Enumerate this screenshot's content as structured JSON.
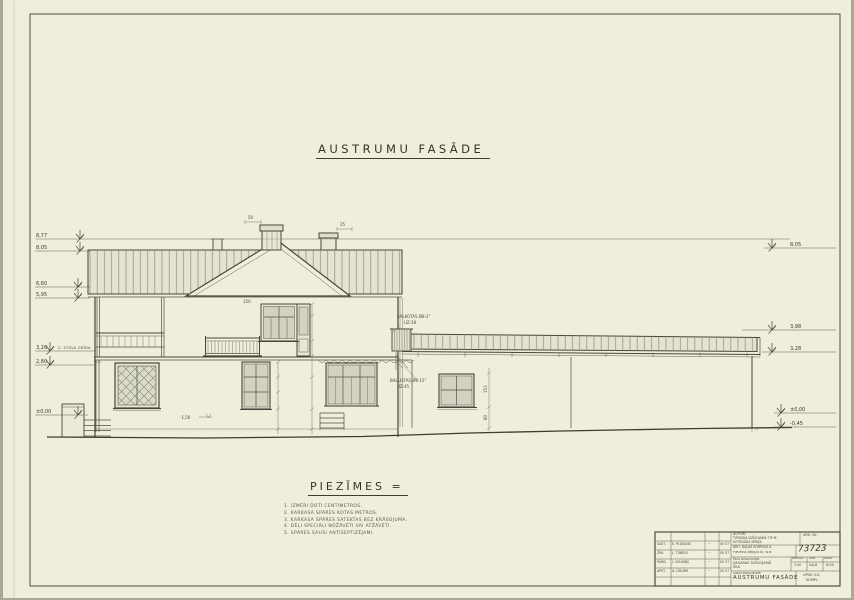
{
  "sheet": {
    "title": "AUSTRUMU  FASĀDE"
  },
  "notes": {
    "heading": "PIEZĪMES =",
    "items": [
      "1. IZMĒRI DOTI CENTIMETROS.",
      "2. KARKASA SPĀRES KOTAS METROS.",
      "3. KARKASA SPĀRES SATEKTAS BEZ KRĀSOJUMA.",
      "4. DĒĻI SPECIĀLI NOŽĀVĒTI VAI ATŽĀVĒTI.",
      "5. SPĀRES SAUSI ANTISEPTIZĒJAMI."
    ]
  },
  "levels": {
    "left": [
      {
        "y": 239,
        "value": "8,77",
        "x2": 790,
        "sym": 80
      },
      {
        "y": 251,
        "value": "8,05",
        "x2": 90,
        "sym": 80
      },
      {
        "y": 287,
        "value": "6,60",
        "x2": 90,
        "sym": 78
      },
      {
        "y": 298,
        "value": "5,95",
        "x2": 90,
        "sym": 78
      },
      {
        "y": 351,
        "value": "3,28",
        "x2": 96,
        "sym": 50,
        "label": "2. STĀVA GRĪDA"
      },
      {
        "y": 365,
        "value": "2,80",
        "x2": 96,
        "sym": 50
      },
      {
        "y": 415,
        "value": "±0,00",
        "x2": 88,
        "sym": 78
      }
    ],
    "right": [
      {
        "y": 248,
        "value": "8,05",
        "x1": 764,
        "sym": 772
      },
      {
        "y": 330,
        "value": "3,98",
        "x1": 742,
        "sym": 772
      },
      {
        "y": 352,
        "value": "3,28",
        "x1": 762,
        "sym": 772
      },
      {
        "y": 413,
        "value": "±0,00",
        "x1": 774,
        "sym": 781
      },
      {
        "y": 427,
        "value": "-0,45",
        "x1": 774,
        "sym": 781
      }
    ]
  },
  "annotations": {
    "roof_note1": "ŠALKOTAS Ø8-2\"",
    "roof_note2": "UZ-28",
    "bracket_note1": "BALLISTAS Ø6-15\"",
    "bracket_note2": "UZ-45",
    "dim_chimney1": "50",
    "dim_chimney2": "25",
    "dim_gable": "150.",
    "dim_ground": "-1,50",
    "wing_dim1": "153",
    "wing_dim2": "80"
  },
  "titleblock": {
    "autori_label": "AUTORI:",
    "project_line1": "TIPVEIDA DZĪVOJAMĀ TIP M.",
    "project_line2": "KOTEDŽAS SĒRIJA",
    "arh_nr_label": "ARH. Nr.",
    "korpuss_line1": "ARH. DAĻAS KORPUSS A",
    "korpuss_line2": "TIPVEIDA SĒRIJAS Nr. W-N",
    "doc_number": "73723",
    "object_label": "ĒKAS NOSAUKUMS:",
    "object_line1": "VASARAS DZĪVOJAMĀ",
    "object_line2": "ĒKA",
    "scale_label": "MĒROGS",
    "scale_value": "1:50",
    "sheet_label": "LAPA",
    "sheet_value": "UA-8",
    "sheets_label": "LAPAS",
    "sheets_value": "N:20",
    "sheet_name_label": "LAPAS NOSAUKUMS:",
    "sheet_name": "AUSTRUMU FASĀDE",
    "org_line1": "UPDK O.K.",
    "org_line2": "KOMPL.",
    "signatures": [
      {
        "label": "SAST.",
        "name": "K. PLŪKSNE",
        "sig": "~",
        "date": "VII 57"
      },
      {
        "label": "ZĪM.",
        "name": "L. TŪBELE",
        "sig": "~",
        "date": "VII 57"
      },
      {
        "label": "PĀRB.",
        "name": "J. CELMIŅŠ",
        "sig": "~",
        "date": "VII 57"
      },
      {
        "label": "APST.",
        "name": "A. LĪDUMS",
        "sig": "~",
        "date": "VII 57"
      }
    ]
  }
}
